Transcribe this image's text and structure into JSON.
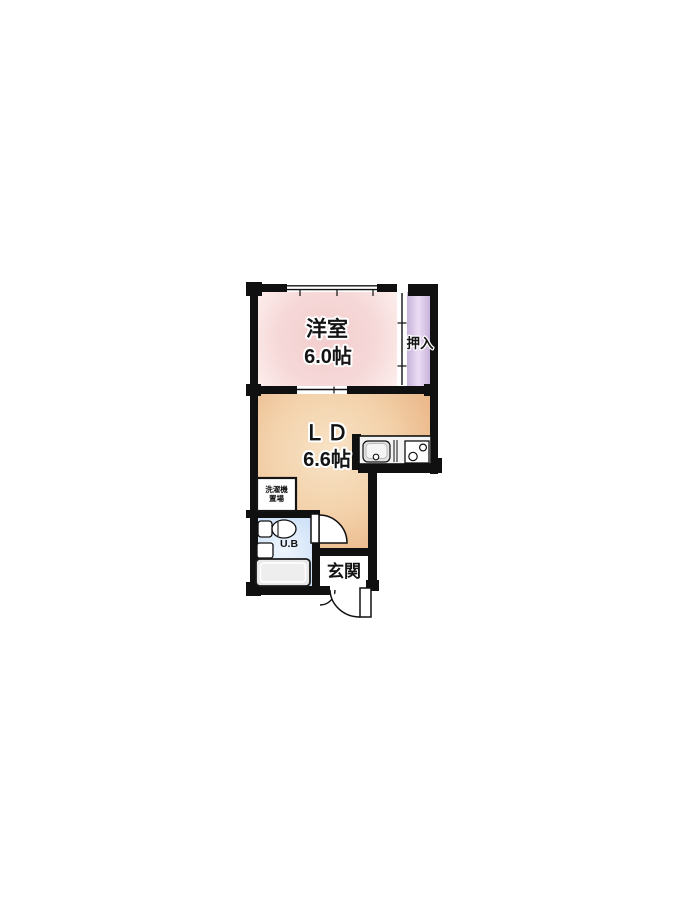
{
  "plan": {
    "type": "japanese-apartment-floor-plan",
    "rooms": {
      "western_room": {
        "name": "洋室",
        "size": "6.0帖"
      },
      "living_dining": {
        "name": "ＬＤ",
        "size": "6.6帖"
      },
      "closet": {
        "name": "押入"
      },
      "entrance": {
        "name": "玄関"
      },
      "unit_bath": {
        "name": "U.B"
      },
      "laundry": {
        "line1": "洗濯機",
        "line2": "置場"
      }
    },
    "fixtures": [
      "kitchen-sink",
      "two-burner-stove",
      "toilet",
      "washbasin",
      "bathtub",
      "washing-machine-space"
    ],
    "colors": {
      "wall": "#101010",
      "western_room_center": "#f3cdcd",
      "western_room_edge": "#fdf1ef",
      "living_dining_center": "#f8e3c6",
      "living_dining_edge": "#ebb88a",
      "closet_center": "#ecdcf4",
      "closet_edge": "#c7b3da",
      "unit_bath_center": "#ecf4fd",
      "unit_bath_edge": "#b9d4f0",
      "entrance_floor": "#ffffff",
      "fixture_gray": "#e8e8e8"
    }
  }
}
